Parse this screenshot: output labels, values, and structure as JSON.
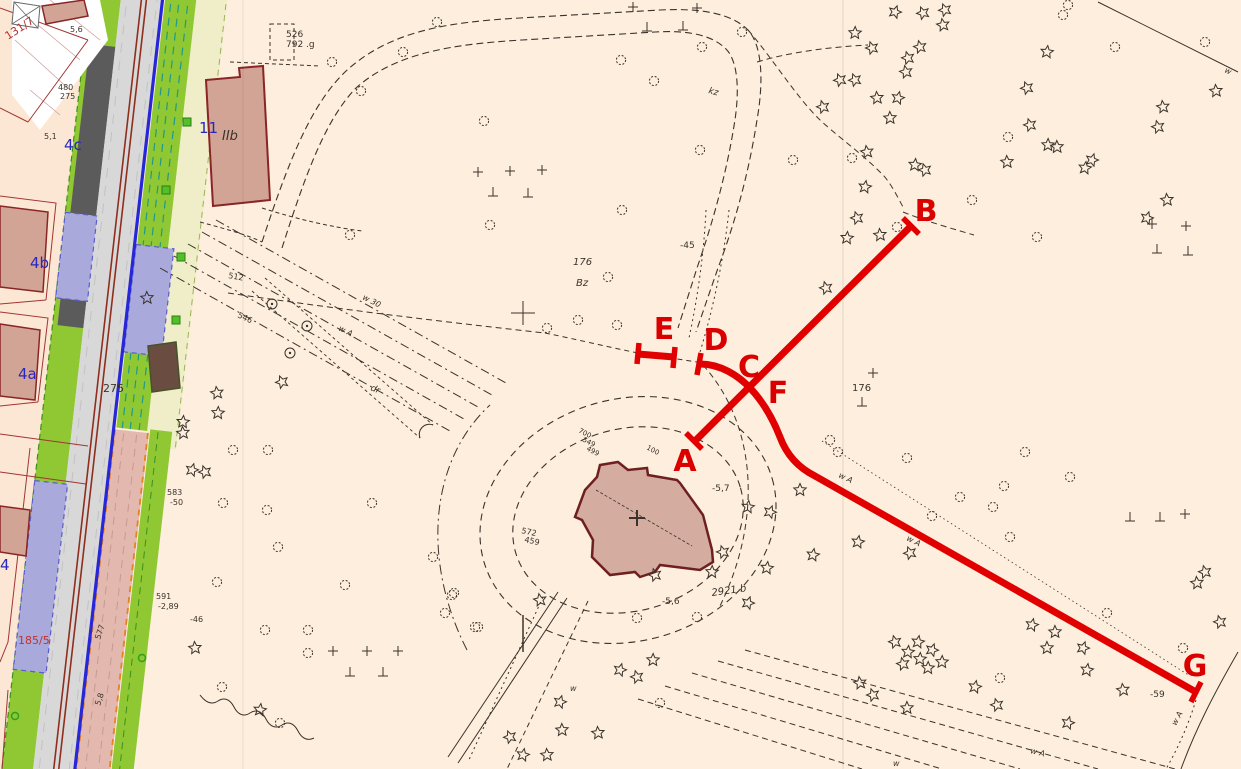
{
  "map": {
    "colors": {
      "background": "#fdeedd",
      "parcel_background": "#fbe7d3",
      "building_fill": "#d2a496",
      "building_stroke": "#8a2525",
      "church_fill": "#d4aca0",
      "church_stroke": "#6e1f1f",
      "grass_green": "#8fc832",
      "pale_yellow": "#efeec8",
      "lavender": "#a9a9dc",
      "road_gray": "#d8d8d8",
      "dark_gray": "#5b5b5b",
      "pink_strip": "#e3b8ae",
      "orange_dash": "#e8821e",
      "blue_line": "#2727d8",
      "tram_line": "#8f2e1e",
      "teal_dash": "#20998a",
      "linework": "#3a332b",
      "red_overlay": "#e10000",
      "red_label": "#da0000",
      "blue_label": "#2727bf",
      "red_text": "#b03030"
    },
    "red_overlay": {
      "stroke_width": 7,
      "segments": [
        {
          "id": "segment-A-B",
          "d": "M693,443 L911,226"
        },
        {
          "id": "segment-D-C-F-G",
          "d": "M700,364 C720,364 738,375 751,389 C764,403 773,419 780,437 C787,456 799,468 815,476 L1196,692"
        },
        {
          "id": "segment-E",
          "d": "M638,354 L674,357"
        }
      ],
      "ticks": [
        {
          "id": "tick-A",
          "d": "M686,433 L702,449"
        },
        {
          "id": "tick-B",
          "d": "M903,218 L919,234"
        },
        {
          "id": "tick-D",
          "d": "M701,353 L697,375"
        },
        {
          "id": "tick-E-left",
          "d": "M639,343 L637,364"
        },
        {
          "id": "tick-E-right",
          "d": "M675,347 L673,368"
        },
        {
          "id": "tick-G",
          "d": "M1191,702 L1201,682"
        }
      ],
      "labels": [
        {
          "t": "A",
          "x": 685,
          "y": 471
        },
        {
          "t": "B",
          "x": 926,
          "y": 221
        },
        {
          "t": "C",
          "x": 749,
          "y": 377
        },
        {
          "t": "D",
          "x": 716,
          "y": 350
        },
        {
          "t": "E",
          "x": 664,
          "y": 339
        },
        {
          "t": "F",
          "x": 778,
          "y": 403
        },
        {
          "t": "G",
          "x": 1195,
          "y": 676
        }
      ]
    },
    "texts": [
      {
        "t": "11",
        "x": 199,
        "y": 133,
        "s": 15,
        "c": "#2727bf"
      },
      {
        "t": "IIb",
        "x": 222,
        "y": 140,
        "s": 13,
        "i": 1
      },
      {
        "t": "4c",
        "x": 64,
        "y": 150,
        "s": 15,
        "c": "#2727bf"
      },
      {
        "t": "4b",
        "x": 30,
        "y": 268,
        "s": 15,
        "c": "#2727bf"
      },
      {
        "t": "4a",
        "x": 18,
        "y": 379,
        "s": 15,
        "c": "#2727bf"
      },
      {
        "t": "4",
        "x": 0,
        "y": 570,
        "s": 15,
        "c": "#2727bf"
      },
      {
        "t": "131/7",
        "x": 8,
        "y": 40,
        "s": 11,
        "c": "#b03030",
        "r": -33
      },
      {
        "t": "185/5",
        "x": 18,
        "y": 644,
        "s": 11,
        "c": "#c03030"
      },
      {
        "t": "275",
        "x": 103,
        "y": 392,
        "s": 11
      },
      {
        "t": "526",
        "x": 286,
        "y": 37,
        "s": 9
      },
      {
        "t": "792 .g",
        "x": 286,
        "y": 47,
        "s": 9
      },
      {
        "t": "176",
        "x": 573,
        "y": 265,
        "s": 10,
        "i": 1
      },
      {
        "t": "Bz",
        "x": 576,
        "y": 286,
        "s": 10,
        "i": 1
      },
      {
        "t": "-45",
        "x": 680,
        "y": 248,
        "s": 9
      },
      {
        "t": "176",
        "x": 852,
        "y": 391,
        "s": 10
      },
      {
        "t": "2921 b",
        "x": 712,
        "y": 596,
        "s": 10,
        "r": -8,
        "i": 1
      },
      {
        "t": "-5,6",
        "x": 662,
        "y": 604,
        "s": 9
      },
      {
        "t": "-5,7",
        "x": 712,
        "y": 491,
        "s": 9
      },
      {
        "t": "-59",
        "x": 1150,
        "y": 697,
        "s": 9
      },
      {
        "t": "583",
        "x": 167,
        "y": 495,
        "s": 8
      },
      {
        "t": "-50",
        "x": 170,
        "y": 505,
        "s": 8
      },
      {
        "t": "591",
        "x": 156,
        "y": 599,
        "s": 8
      },
      {
        "t": "-2,89",
        "x": 158,
        "y": 609,
        "s": 8
      },
      {
        "t": "-46",
        "x": 190,
        "y": 622,
        "s": 8
      },
      {
        "t": "480",
        "x": 58,
        "y": 90,
        "s": 8
      },
      {
        "t": "275",
        "x": 60,
        "y": 99,
        "s": 8
      },
      {
        "t": "5,6",
        "x": 70,
        "y": 32,
        "s": 8
      },
      {
        "t": "5,1",
        "x": 44,
        "y": 139,
        "s": 8
      },
      {
        "t": "577",
        "x": 100,
        "y": 640,
        "s": 8,
        "r": -72
      },
      {
        "t": "5,8",
        "x": 100,
        "y": 706,
        "s": 8,
        "r": -72
      },
      {
        "t": "512",
        "x": 228,
        "y": 278,
        "s": 8,
        "r": 10
      },
      {
        "t": "546",
        "x": 237,
        "y": 317,
        "s": 8,
        "r": 25
      },
      {
        "t": "w 30",
        "x": 362,
        "y": 299,
        "s": 8,
        "r": 27,
        "i": 1
      },
      {
        "t": "w A",
        "x": 338,
        "y": 330,
        "s": 8,
        "r": 27,
        "i": 1
      },
      {
        "t": "dr",
        "x": 370,
        "y": 390,
        "s": 9,
        "r": 22,
        "i": 1
      },
      {
        "t": "700",
        "x": 578,
        "y": 432,
        "s": 7,
        "r": 28
      },
      {
        "t": "549",
        "x": 582,
        "y": 441,
        "s": 7,
        "r": 28
      },
      {
        "t": "499",
        "x": 586,
        "y": 450,
        "s": 7,
        "r": 28
      },
      {
        "t": "100",
        "x": 646,
        "y": 449,
        "s": 7,
        "r": 28
      },
      {
        "t": "572",
        "x": 521,
        "y": 533,
        "s": 8,
        "r": 12
      },
      {
        "t": "459",
        "x": 524,
        "y": 542,
        "s": 8,
        "r": 12
      },
      {
        "t": "kz",
        "x": 708,
        "y": 93,
        "s": 9,
        "i": 1,
        "r": 15
      },
      {
        "t": "w A",
        "x": 838,
        "y": 477,
        "s": 8,
        "r": 26,
        "i": 1
      },
      {
        "t": "w A",
        "x": 906,
        "y": 540,
        "s": 8,
        "r": 27,
        "i": 1
      },
      {
        "t": "w A",
        "x": 1176,
        "y": 726,
        "s": 8,
        "r": -62,
        "i": 1
      },
      {
        "t": "w A",
        "x": 1030,
        "y": 753,
        "s": 8,
        "r": 14,
        "i": 1
      },
      {
        "t": "w",
        "x": 570,
        "y": 691,
        "s": 8,
        "i": 1
      },
      {
        "t": "w",
        "x": 893,
        "y": 766,
        "s": 8,
        "i": 1
      },
      {
        "t": "w",
        "x": 1224,
        "y": 72,
        "s": 8,
        "i": 1,
        "r": 25
      }
    ],
    "trees": {
      "conifers": [
        [
          895,
          12
        ],
        [
          923,
          13
        ],
        [
          945,
          10
        ],
        [
          943,
          25
        ],
        [
          855,
          33
        ],
        [
          872,
          48
        ],
        [
          908,
          58
        ],
        [
          920,
          47
        ],
        [
          906,
          72
        ],
        [
          840,
          80
        ],
        [
          855,
          80
        ],
        [
          877,
          98
        ],
        [
          898,
          98
        ],
        [
          823,
          107
        ],
        [
          890,
          118
        ],
        [
          1216,
          91
        ],
        [
          1047,
          52
        ],
        [
          1027,
          88
        ],
        [
          1030,
          125
        ],
        [
          1163,
          107
        ],
        [
          1158,
          127
        ],
        [
          1048,
          145
        ],
        [
          1057,
          147
        ],
        [
          1092,
          160
        ],
        [
          1085,
          168
        ],
        [
          1007,
          162
        ],
        [
          865,
          187
        ],
        [
          925,
          170
        ],
        [
          915,
          165
        ],
        [
          867,
          152
        ],
        [
          1167,
          200
        ],
        [
          1147,
          218
        ],
        [
          857,
          218
        ],
        [
          847,
          238
        ],
        [
          880,
          235
        ],
        [
          826,
          288
        ],
        [
          800,
          490
        ],
        [
          813,
          555
        ],
        [
          858,
          542
        ],
        [
          910,
          553
        ],
        [
          183,
          433
        ],
        [
          192,
          470
        ],
        [
          205,
          472
        ],
        [
          195,
          648
        ],
        [
          260,
          710
        ],
        [
          217,
          393
        ],
        [
          218,
          413
        ],
        [
          183,
          422
        ],
        [
          282,
          382
        ],
        [
          147,
          298
        ],
        [
          540,
          600
        ],
        [
          560,
          702
        ],
        [
          510,
          737
        ],
        [
          562,
          730
        ],
        [
          598,
          733
        ],
        [
          523,
          755
        ],
        [
          547,
          755
        ],
        [
          653,
          660
        ],
        [
          637,
          677
        ],
        [
          620,
          670
        ],
        [
          1032,
          625
        ],
        [
          1055,
          632
        ],
        [
          1047,
          648
        ],
        [
          1083,
          648
        ],
        [
          1087,
          670
        ],
        [
          1123,
          690
        ],
        [
          975,
          687
        ],
        [
          997,
          705
        ],
        [
          907,
          708
        ],
        [
          860,
          683
        ],
        [
          873,
          695
        ],
        [
          1068,
          723
        ],
        [
          1197,
          583
        ],
        [
          1220,
          622
        ],
        [
          1205,
          572
        ],
        [
          895,
          642
        ],
        [
          908,
          652
        ],
        [
          920,
          659
        ],
        [
          932,
          650
        ],
        [
          918,
          642
        ],
        [
          928,
          668
        ],
        [
          903,
          664
        ],
        [
          942,
          662
        ],
        [
          748,
          507
        ],
        [
          770,
          512
        ],
        [
          748,
          603
        ],
        [
          767,
          568
        ],
        [
          655,
          575
        ],
        [
          712,
          572
        ],
        [
          723,
          552
        ]
      ],
      "deciduous": [
        [
          437,
          22
        ],
        [
          403,
          52
        ],
        [
          332,
          62
        ],
        [
          361,
          91
        ],
        [
          484,
          121
        ],
        [
          621,
          60
        ],
        [
          654,
          81
        ],
        [
          702,
          47
        ],
        [
          742,
          32
        ],
        [
          700,
          150
        ],
        [
          622,
          210
        ],
        [
          490,
          225
        ],
        [
          350,
          235
        ],
        [
          1068,
          5
        ],
        [
          1063,
          15
        ],
        [
          1115,
          47
        ],
        [
          1205,
          42
        ],
        [
          1008,
          137
        ],
        [
          793,
          160
        ],
        [
          852,
          158
        ],
        [
          897,
          227
        ],
        [
          972,
          200
        ],
        [
          1037,
          237
        ],
        [
          830,
          440
        ],
        [
          838,
          452
        ],
        [
          907,
          458
        ],
        [
          960,
          497
        ],
        [
          1025,
          452
        ],
        [
          1070,
          477
        ],
        [
          1004,
          486
        ],
        [
          932,
          516
        ],
        [
          993,
          507
        ],
        [
          1010,
          537
        ],
        [
          1107,
          613
        ],
        [
          1183,
          648
        ],
        [
          1000,
          678
        ],
        [
          233,
          450
        ],
        [
          268,
          450
        ],
        [
          223,
          503
        ],
        [
          267,
          510
        ],
        [
          372,
          503
        ],
        [
          278,
          547
        ],
        [
          217,
          582
        ],
        [
          345,
          585
        ],
        [
          265,
          630
        ],
        [
          308,
          630
        ],
        [
          308,
          653
        ],
        [
          222,
          687
        ],
        [
          280,
          723
        ],
        [
          454,
          593
        ],
        [
          445,
          613
        ],
        [
          475,
          627
        ],
        [
          433,
          557
        ],
        [
          547,
          328
        ],
        [
          578,
          320
        ],
        [
          617,
          325
        ],
        [
          608,
          277
        ],
        [
          637,
          618
        ],
        [
          697,
          617
        ],
        [
          452,
          595
        ],
        [
          478,
          627
        ],
        [
          660,
          703
        ]
      ]
    },
    "symbols": {
      "perp": [
        [
          493,
          193
        ],
        [
          528,
          194
        ],
        [
          647,
          28
        ],
        [
          683,
          27
        ],
        [
          350,
          673
        ],
        [
          383,
          673
        ],
        [
          862,
          403
        ],
        [
          1157,
          250
        ],
        [
          1188,
          252
        ],
        [
          1130,
          518
        ],
        [
          1160,
          518
        ]
      ],
      "plus": [
        [
          478,
          172
        ],
        [
          510,
          171
        ],
        [
          542,
          170
        ],
        [
          633,
          7
        ],
        [
          697,
          8
        ],
        [
          333,
          651
        ],
        [
          367,
          651
        ],
        [
          398,
          651
        ],
        [
          873,
          373
        ],
        [
          1152,
          224
        ],
        [
          1186,
          226
        ],
        [
          1185,
          514
        ]
      ],
      "cross": [
        [
          523,
          313
        ]
      ],
      "lamps": [
        [
          272,
          304
        ],
        [
          307,
          326
        ],
        [
          290,
          353
        ]
      ],
      "green_squares": [
        [
          187,
          122
        ],
        [
          166,
          190
        ],
        [
          181,
          257
        ],
        [
          176,
          320
        ]
      ],
      "green_dots": [
        [
          15,
          716
        ],
        [
          142,
          658
        ]
      ]
    }
  }
}
